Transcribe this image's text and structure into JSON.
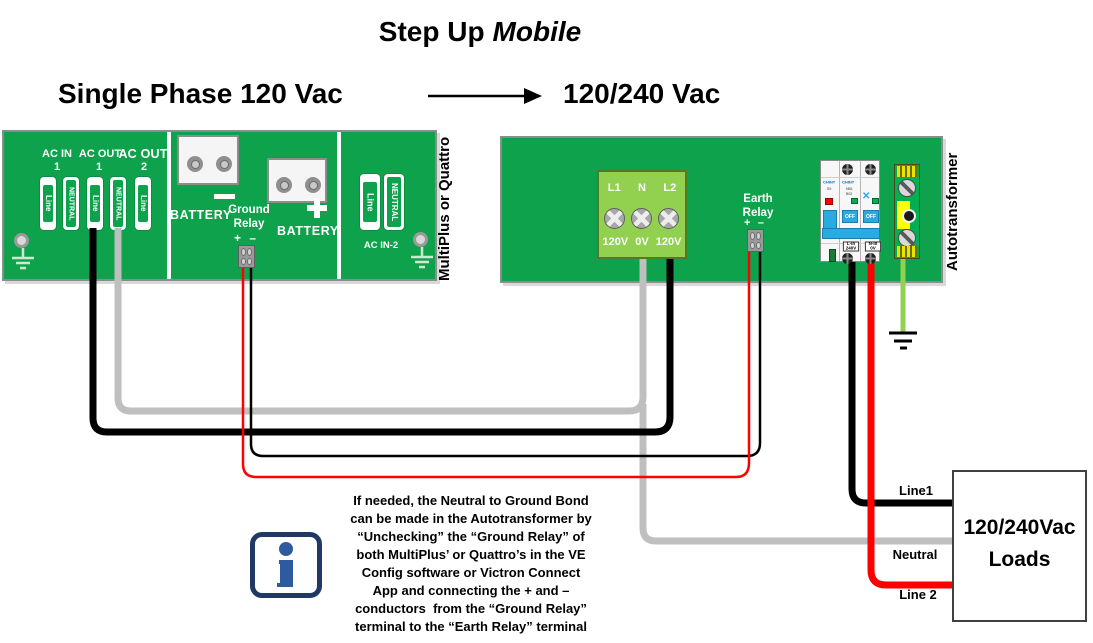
{
  "header": {
    "title_main": "Step Up",
    "title_accent": "Mobile",
    "source_label": "Single Phase 120 Vac",
    "target_label": "120/240 Vac"
  },
  "inverter": {
    "side_label": "MultiPlus or Quattro",
    "ac_in_label": "AC IN",
    "ac_in_num": "1",
    "ac_out1_label": "AC OUT",
    "ac_out1_num": "1",
    "ac_out2_label": "AC OUT",
    "ac_out2_num": "2",
    "terminals": {
      "ac_in_line": "Line",
      "ac_in_neutral": "NEUTRAL",
      "ac_out1_line": "Line",
      "ac_out1_neutral": "NEUTRAL",
      "ac_out2_line": "Line",
      "ac_in2_line": "Line",
      "ac_in2_neutral": "NEUTRAL"
    },
    "battery_neg_label": "BATTERY",
    "battery_pos_label": "BATTERY",
    "ground_relay": {
      "line1": "Ground",
      "line2": "Relay",
      "plus": "+",
      "minus": "–"
    },
    "ac_in2_label": "AC IN-2"
  },
  "autotransformer": {
    "side_label": "Autotransformer",
    "input_block": {
      "l1": "L1",
      "n": "N",
      "l2": "L2",
      "l1_v": "120V",
      "n_v": "0V",
      "l2_v": "120V"
    },
    "earth_relay": {
      "line1": "Earth",
      "line2": "Relay",
      "plus": "+",
      "minus": "–"
    },
    "breaker": {
      "brand_left": "CHINT",
      "model_left": "S9",
      "brand_mid": "CHINT",
      "model_mid": "NB1",
      "model_mid2": "B02",
      "toggle_mid": "OFF",
      "toggle_right": "OFF",
      "term_left_line1": "L-in",
      "term_left_line2": "240V",
      "term_right_line1": "N-in",
      "term_right_line2": "0V"
    }
  },
  "loads_box": {
    "line1": "120/240Vac",
    "line2": "Loads"
  },
  "wire_labels": {
    "line1": "Line1",
    "neutral": "Neutral",
    "line2": "Line 2"
  },
  "note": {
    "lines": [
      "If needed, the Neutral to Ground Bond",
      "can be made in the Autotransformer by",
      "“Unchecking” the “Ground Relay” of",
      "both MultiPlus’ or Quattro’s in the VE",
      "Config software or Victron Connect",
      "App and connecting the + and –",
      "conductors  from the “Ground Relay”",
      "terminal to the “Earth Relay” terminal"
    ]
  },
  "colors": {
    "board_green": "#0ea24c",
    "block_green": "#92d050",
    "wire_gray": "#bfbfbf",
    "wire_red": "#ff0000",
    "wire_black": "#000000",
    "ground_wire_green": "#92d050",
    "breaker_blue": "#29abe2",
    "chint_blue": "#0070c0",
    "info_border_navy": "#1f3864",
    "info_i_blue": "#2e5b9f"
  }
}
